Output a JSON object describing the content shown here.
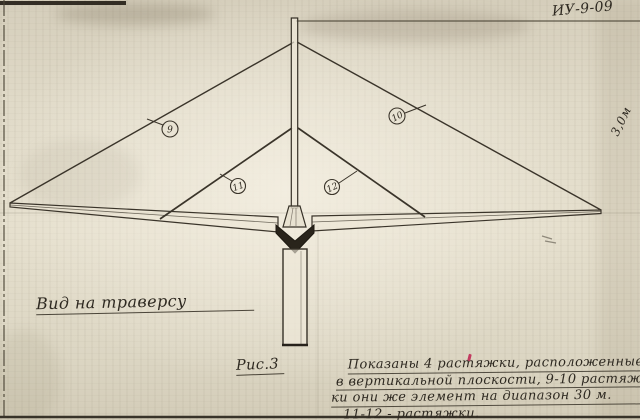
{
  "document": {
    "doc_number": "ИУ-9-09",
    "dimension_note": "3,0м",
    "view_label": "Вид на траверсу",
    "figure_label": "Рис.3",
    "note": {
      "lines": [
        "Показаны 4 растяжки, расположенные",
        "в вертикальной плоскости, 9-10 растяж-",
        "ки они же элемент на диапазон 30 м.",
        "11-12 - растяжки."
      ]
    },
    "callouts": [
      {
        "id": "guy-wire-outer-left",
        "text": "9"
      },
      {
        "id": "guy-wire-outer-right",
        "text": "10"
      },
      {
        "id": "guy-wire-inner-left",
        "text": "11"
      },
      {
        "id": "guy-wire-inner-right",
        "text": "12"
      }
    ],
    "colors": {
      "paper": "#ddd6c4",
      "ink": "#3a342a"
    }
  }
}
